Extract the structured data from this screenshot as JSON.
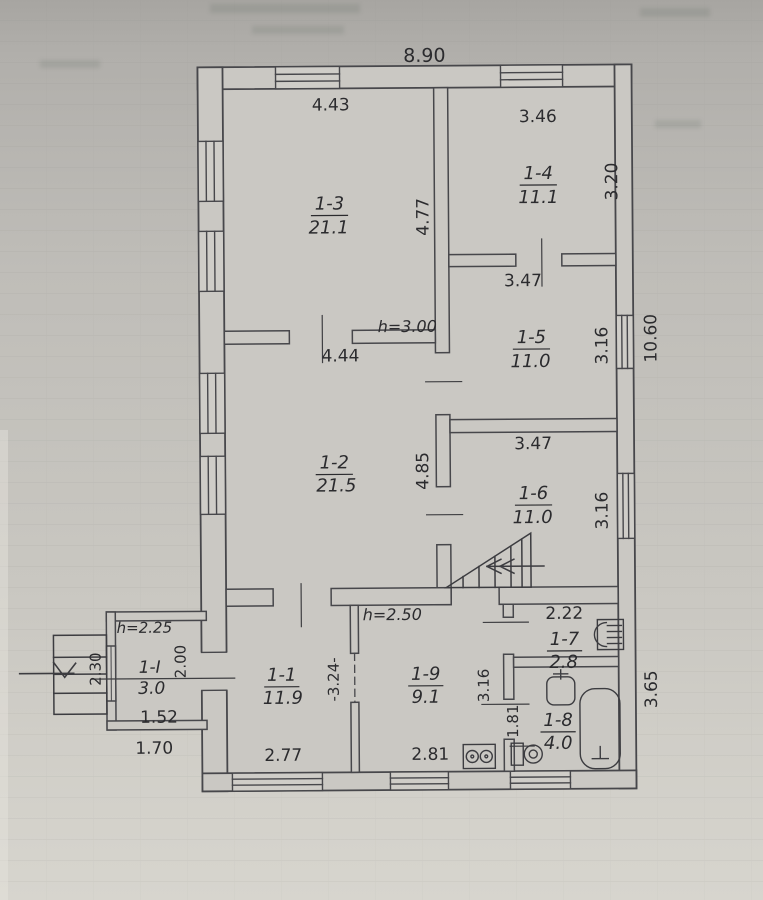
{
  "plan": {
    "overall_dims": {
      "width_top": "8.90",
      "height_right": "10.60",
      "lower_right_height": "3.65"
    },
    "heights": {
      "main_rooms": "h=3.00",
      "hall": "h=2.50",
      "vestibule": "h=2.25"
    },
    "rooms": {
      "r13": {
        "id": "1-3",
        "area": "21.1",
        "width": "4.43",
        "depth": "4.77"
      },
      "r14": {
        "id": "1-4",
        "area": "11.1",
        "width": "3.46",
        "depth": "3.20"
      },
      "r15": {
        "id": "1-5",
        "area": "11.0",
        "width": "3.47",
        "depth": "3.16"
      },
      "r12": {
        "id": "1-2",
        "area": "21.5",
        "width": "4.44",
        "depth": "4.85"
      },
      "r16": {
        "id": "1-6",
        "area": "11.0",
        "width": "3.47",
        "depth": "3.16"
      },
      "r17": {
        "id": "1-7",
        "area": "2.8",
        "width": "2.22"
      },
      "r18": {
        "id": "1-8",
        "area": "4.0",
        "depth": "1.81"
      },
      "r19": {
        "id": "1-9",
        "area": "9.1",
        "width": "2.81",
        "depth": "-3.24-"
      },
      "r11": {
        "id": "1-1",
        "area": "11.9",
        "width": "2.77"
      },
      "r1i": {
        "id": "1-I",
        "area": "3.0",
        "width": "1.52",
        "outer_width": "1.70",
        "depth": "2.30",
        "inner_width": "2.00"
      }
    },
    "hall_dims": {
      "side": "3.16"
    },
    "icons": [
      "stairs-icon",
      "entrance-arrow-icon",
      "entrance-steps-icon",
      "stove-icon",
      "boiler-icon",
      "sink-icon",
      "bathtub-icon",
      "toilet-icon",
      "window-icon",
      "doorway-icon"
    ],
    "colors": {
      "paper": "#c6c4bf",
      "ink": "#3c3c40"
    }
  }
}
